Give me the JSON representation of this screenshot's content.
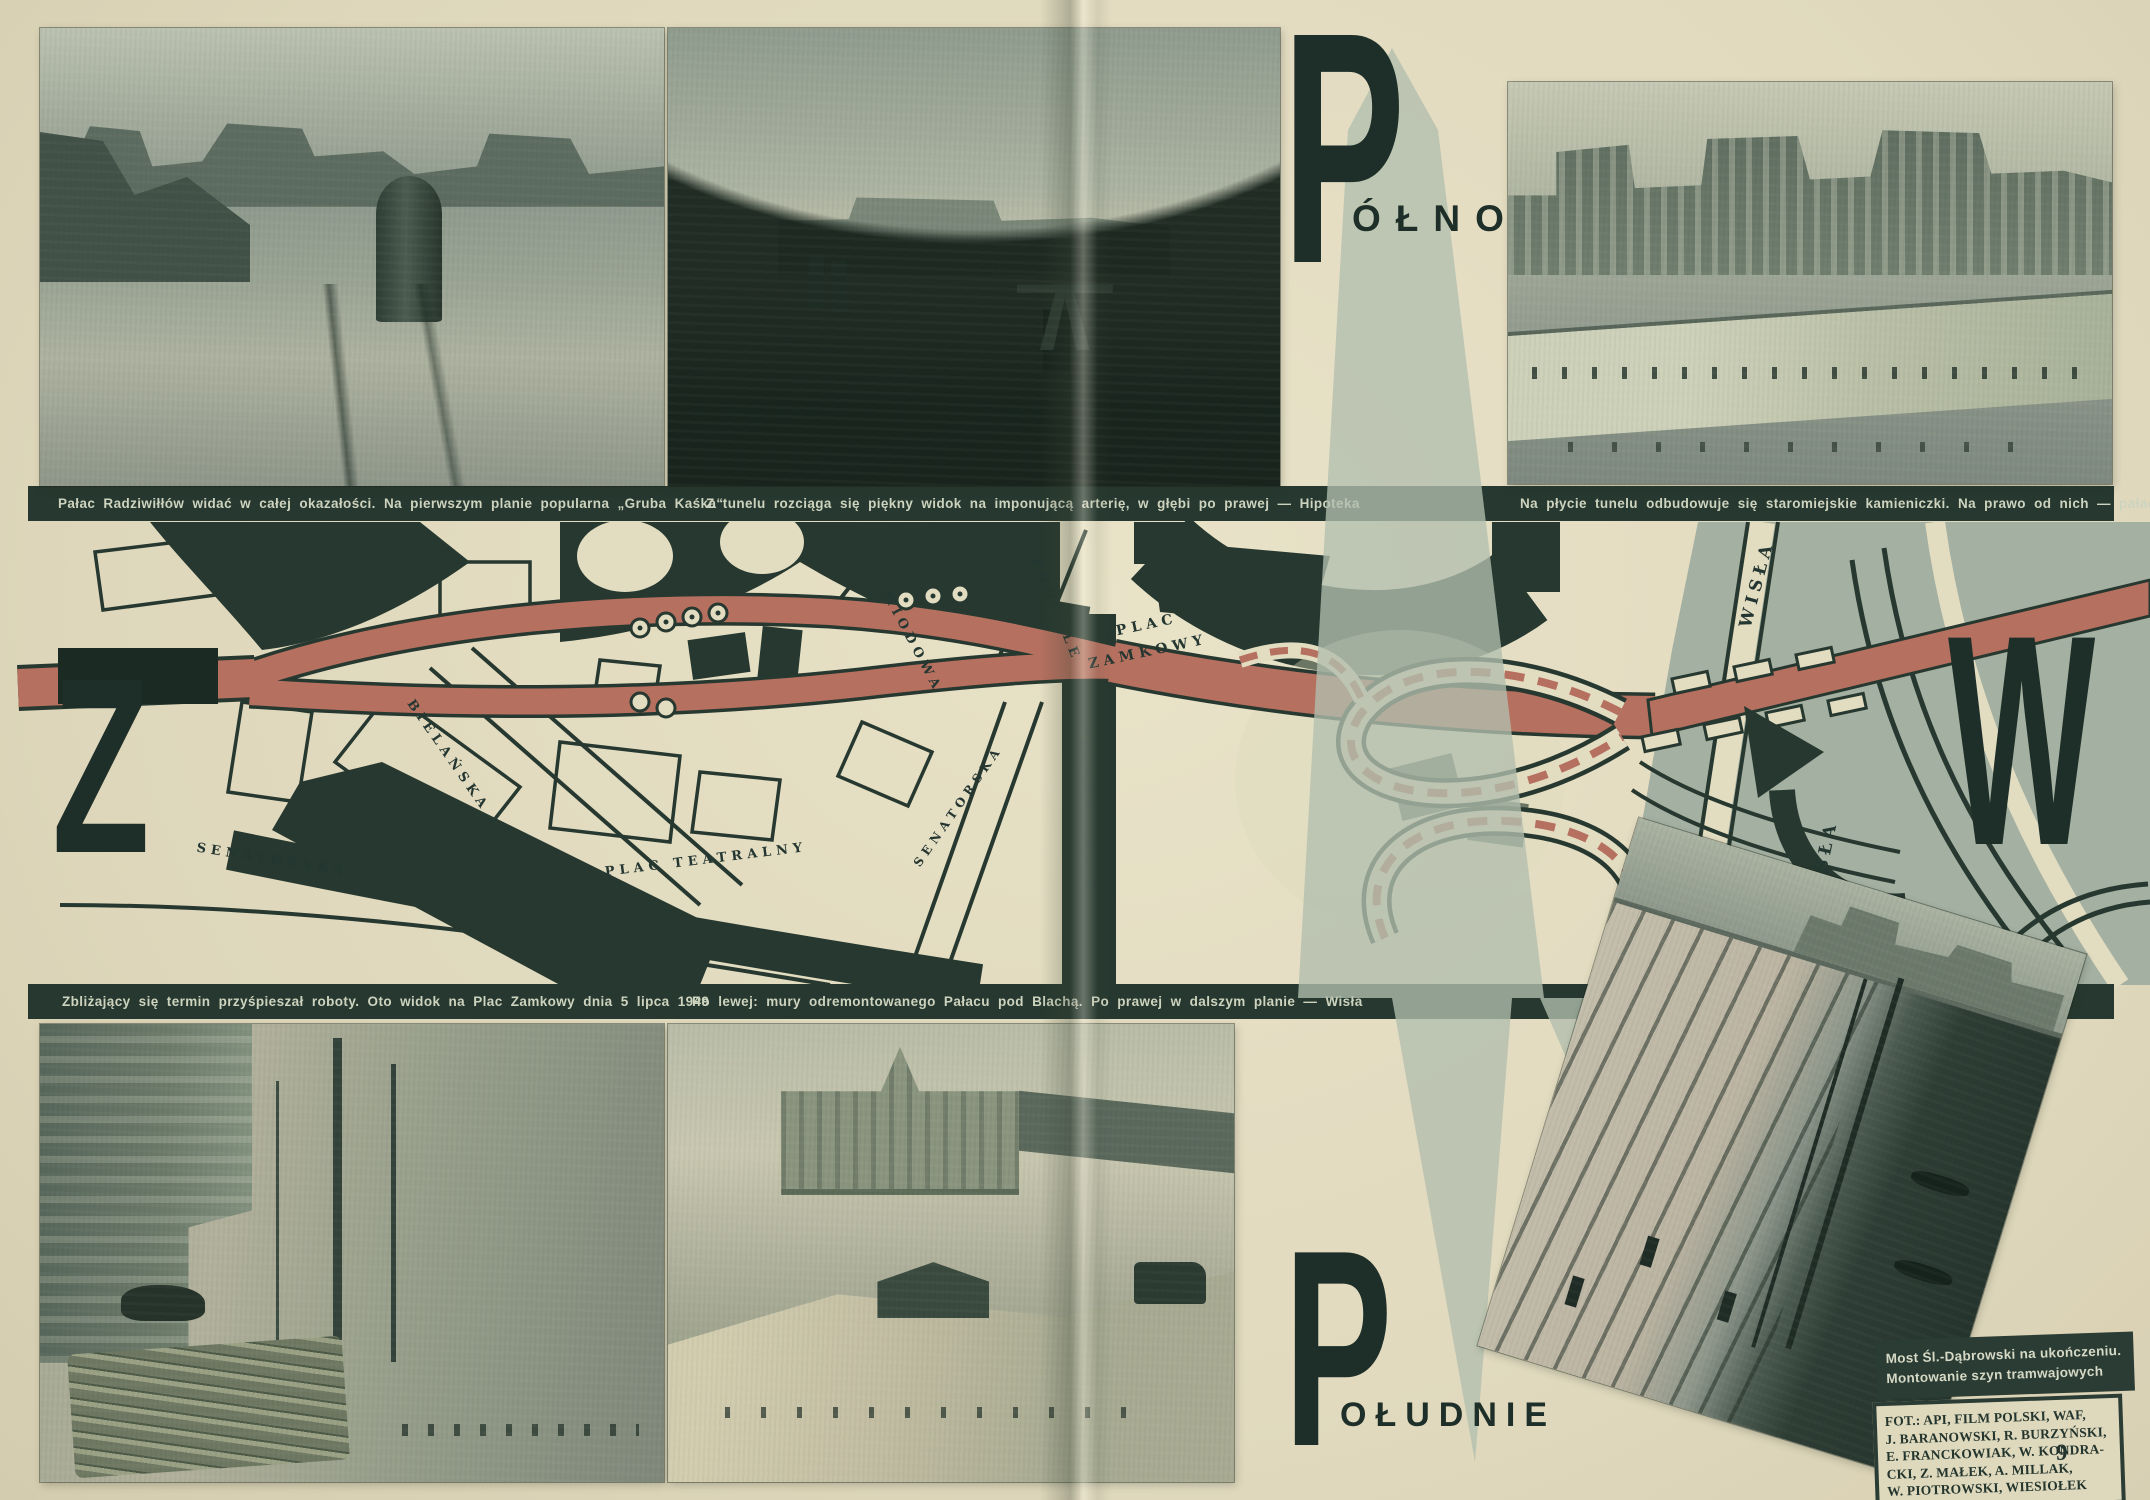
{
  "page_number": "9",
  "compass": {
    "north": {
      "initial": "P",
      "rest": "ÓŁNOC"
    },
    "south": {
      "initial": "P",
      "rest": "OŁUDNIE"
    },
    "west_initial": "Z",
    "east_initial": "W"
  },
  "caption_bar_top": {
    "left": "Pałac Radziwiłłów widać w całej okazałości. Na pierwszym planie popularna „Gruba Kaśka“",
    "middle": "Z tunelu rozciąga się piękny widok na imponującą arterię, w głębi po prawej — Hipoteka",
    "right": "Na płycie tunelu odbudowuje się staromiejskie kamieniczki. Na prawo od nich — pałac Sołtyka"
  },
  "caption_bar_middle": {
    "left": "Zbliżający się termin przyśpieszał roboty. Oto widok na Plac Zamkowy dnia 5 lipca 1949",
    "right": "Po lewej: mury odremontowanego Pałacu pod Blachą. Po prawej w dalszym planie — Wisła"
  },
  "photo_note": {
    "line1": "Most Śl.-Dąbrowski na ukończeniu.",
    "line2": "Montowanie szyn tramwajowych"
  },
  "credits_lines": [
    "FOT.: API, FILM POLSKI, WAF,",
    "J. BARANOWSKI, R. BURZYŃSKI,",
    "E. FRANCKOWIAK, W. KONDRA-",
    "CKI, Z. MAŁEK, A. MILLAK,",
    "W. PIOTROWSKI, WIESIOŁEK"
  ],
  "map_labels": [
    {
      "text": "BIELAŃSKA",
      "x": 448,
      "y": 756,
      "rot": 55,
      "size": 13
    },
    {
      "text": "SENATORSKA",
      "x": 272,
      "y": 860,
      "rot": 9,
      "size": 13
    },
    {
      "text": "PLAC TEATRALNY",
      "x": 706,
      "y": 860,
      "rot": -7,
      "size": 13
    },
    {
      "text": "MIODOWA",
      "x": 912,
      "y": 642,
      "rot": 62,
      "size": 13
    },
    {
      "text": "PODWALE",
      "x": 1056,
      "y": 610,
      "rot": 68,
      "size": 13
    },
    {
      "text": "·PLAC",
      "x": 1142,
      "y": 626,
      "rot": -12,
      "size": 14
    },
    {
      "text": "ZAMKOWY",
      "x": 1148,
      "y": 652,
      "rot": -12,
      "size": 14
    },
    {
      "text": "SENATORSKA",
      "x": 958,
      "y": 806,
      "rot": -55,
      "size": 12
    },
    {
      "text": "PRZEDMIEŚCIE",
      "x": 1088,
      "y": 810,
      "rot": 88,
      "size": 12
    },
    {
      "text": "WISŁA",
      "x": 1757,
      "y": 584,
      "rot": -75,
      "size": 17
    },
    {
      "text": "WISŁA",
      "x": 1823,
      "y": 864,
      "rot": -78,
      "size": 17
    }
  ],
  "colors": {
    "paper": "#e2dcc1",
    "ink": "#26382f",
    "route_red": "#b5705f",
    "river": "#a4b0a1",
    "compass_sage": "#b2bfae",
    "caption_text": "#cdd3be"
  }
}
